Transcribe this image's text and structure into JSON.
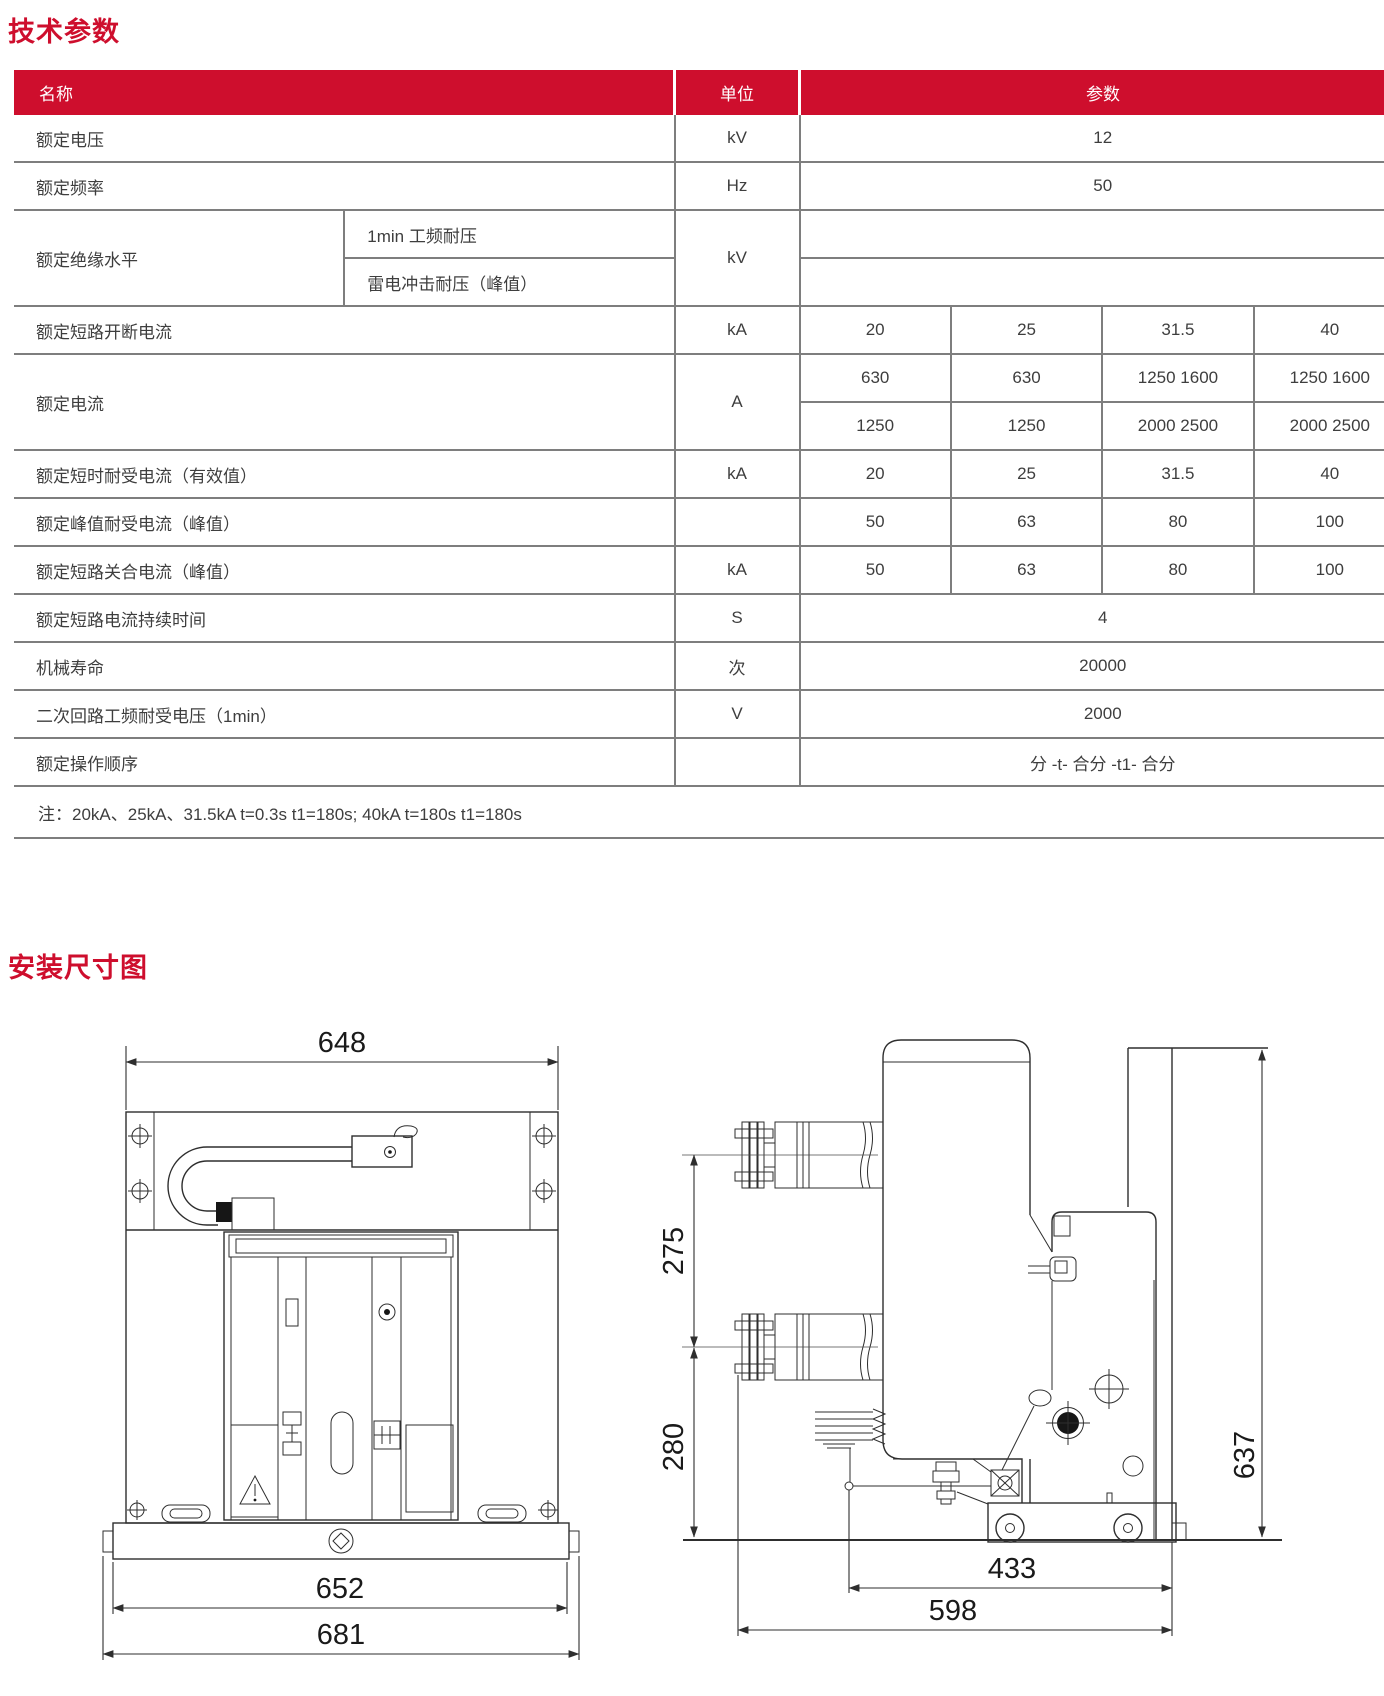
{
  "titles": {
    "tech": "技术参数",
    "install": "安装尺寸图"
  },
  "colors": {
    "accent_red": "#ce0e2d",
    "table_border": "#7e7e7e",
    "text": "#3e3e3e",
    "drawing_line": "#2e2e2e"
  },
  "table": {
    "header": {
      "name": "名称",
      "unit": "单位",
      "param": "参数"
    },
    "r1": {
      "name": "额定电压",
      "unit": "kV",
      "v": "12"
    },
    "r2": {
      "name": "额定频率",
      "unit": "Hz",
      "v": "50"
    },
    "r3": {
      "name": "额定绝缘水平",
      "sub1": "1min 工频耐压",
      "sub2": "雷电冲击耐压（峰值）",
      "unit": "kV",
      "v1": "",
      "v2": ""
    },
    "r4": {
      "name": "额定短路开断电流",
      "unit": "kA",
      "v1": "20",
      "v2": "25",
      "v3": "31.5",
      "v4": "40"
    },
    "r5": {
      "name": "额定电流",
      "unit": "A",
      "a1": "630",
      "a2": "630",
      "a3": "1250 1600",
      "a4": "1250 1600",
      "b1": "1250",
      "b2": "1250",
      "b3": "2000 2500",
      "b4": "2000 2500"
    },
    "r6": {
      "name": "额定短时耐受电流（有效值）",
      "unit": "kA",
      "v1": "20",
      "v2": "25",
      "v3": "31.5",
      "v4": "40"
    },
    "r7": {
      "name": "额定峰值耐受电流（峰值）",
      "unit": "",
      "v1": "50",
      "v2": "63",
      "v3": "80",
      "v4": "100"
    },
    "r8": {
      "name": "额定短路关合电流（峰值）",
      "unit": "kA",
      "v1": "50",
      "v2": "63",
      "v3": "80",
      "v4": "100"
    },
    "r9": {
      "name": "额定短路电流持续时间",
      "unit": "S",
      "v": "4"
    },
    "r10": {
      "name": "机械寿命",
      "unit": "次",
      "v": "20000"
    },
    "r11": {
      "name": "二次回路工频耐受电压（1min）",
      "unit": "V",
      "v": "2000"
    },
    "r12": {
      "name": "额定操作顺序",
      "unit": "",
      "v": "分 -t- 合分 -t1- 合分"
    },
    "note": "注：20kA、25kA、31.5kA  t=0.3s  t1=180s; 40kA  t=180s  t1=180s"
  },
  "drawings": {
    "front": {
      "w_top": "648",
      "w_base": "652",
      "w_overall": "681"
    },
    "side": {
      "d_pole_gap": "275",
      "d_lower": "280",
      "d_height": "637",
      "d_track": "433",
      "d_depth": "598"
    }
  }
}
